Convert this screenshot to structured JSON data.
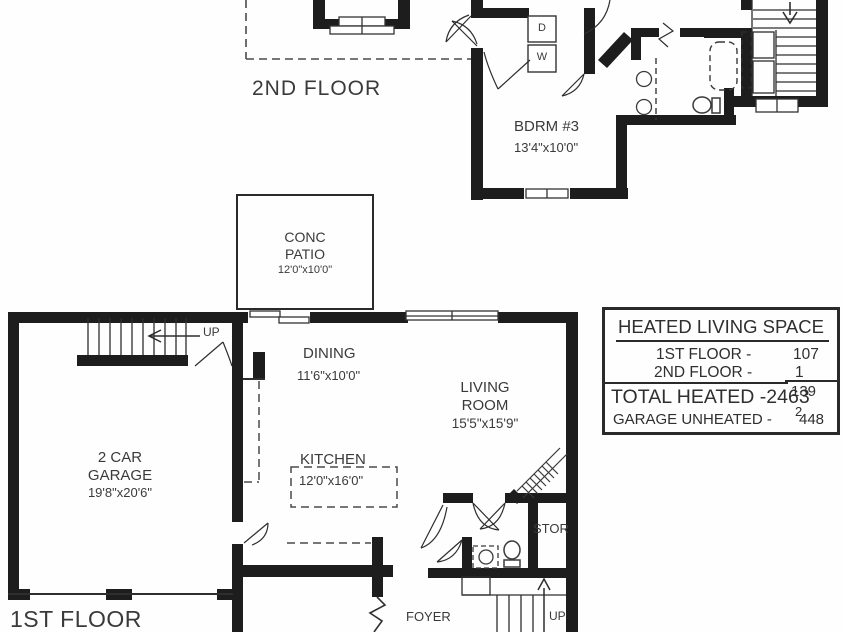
{
  "floors": {
    "second": {
      "label": "2ND FLOOR"
    },
    "first": {
      "label": "1ST FLOOR"
    }
  },
  "rooms": {
    "bdrm3": {
      "name": "BDRM #3",
      "dims": "13'4\"x10'0\""
    },
    "patio": {
      "name_line1": "CONC",
      "name_line2": "PATIO",
      "dims": "12'0\"x10'0\""
    },
    "dining": {
      "name": "DINING",
      "dims": "11'6\"x10'0\""
    },
    "living": {
      "name_line1": "LIVING",
      "name_line2": "ROOM",
      "dims": "15'5\"x15'9\""
    },
    "kitchen": {
      "name": "KITCHEN",
      "dims": "12'0\"x16'0\""
    },
    "garage": {
      "name_line1": "2 CAR",
      "name_line2": "GARAGE",
      "dims": "19'8\"x20'6\""
    },
    "storage": {
      "name": "STOR"
    },
    "foyer": {
      "name": "FOYER"
    }
  },
  "appliances": {
    "dryer": "D",
    "washer": "W"
  },
  "stairs": {
    "up_main": "UP",
    "up_foyer": "UP"
  },
  "legend": {
    "title": "HEATED LIVING SPACE",
    "row1_label": "1ST FLOOR -",
    "row1_value": "107",
    "row2_label": "2ND FLOOR -",
    "row2_value": "1",
    "fragment1": "139",
    "total": "TOTAL HEATED -2463",
    "fragment2": "2",
    "garage_label": "GARAGE UNHEATED -",
    "garage_value": "448"
  },
  "colors": {
    "wall": "#1d1d1d",
    "text": "#3a3a3a",
    "background": "#ffffff"
  }
}
